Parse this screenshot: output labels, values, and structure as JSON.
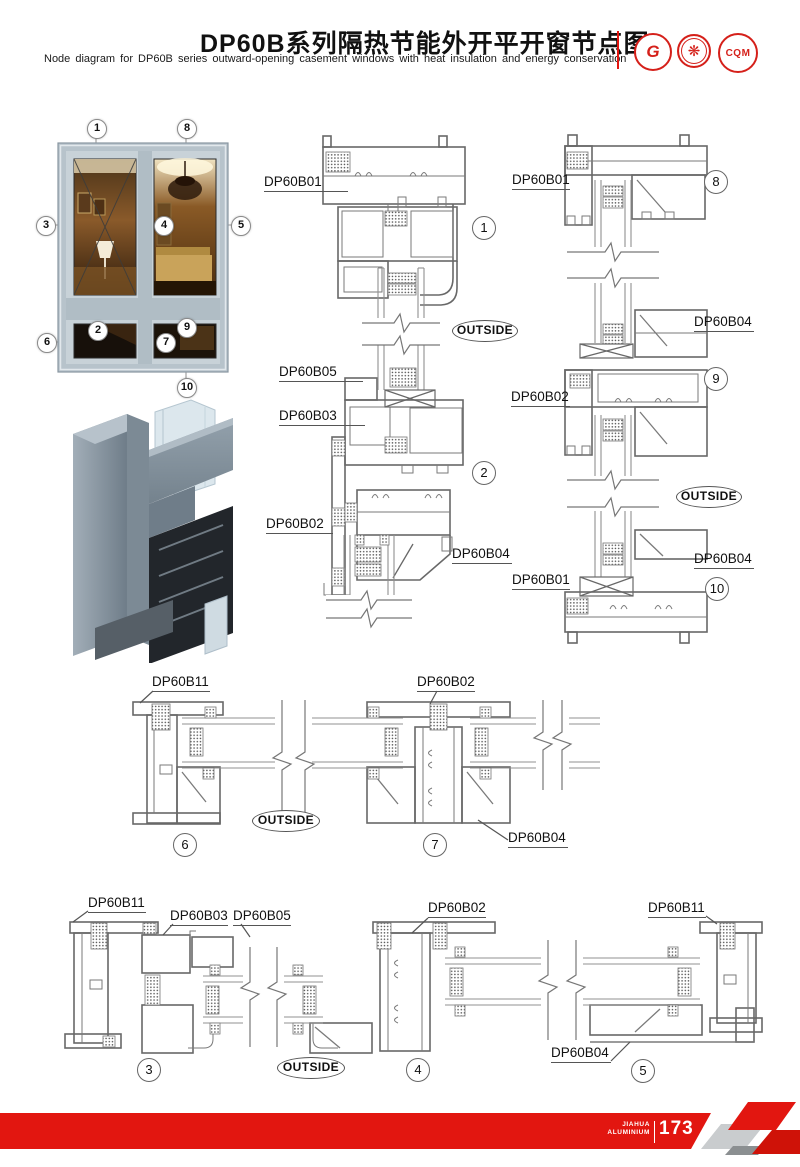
{
  "header": {
    "title": "DP60B系列隔热节能外开平开窗节点图",
    "subtitle": "Node diagram for DP60B series outward-opening casement windows with heat insulation and energy conservation",
    "logos": {
      "gb": "G",
      "seal": "❋",
      "cqm": "CQM"
    }
  },
  "photo": {
    "callouts": [
      "1",
      "8",
      "3",
      "4",
      "5",
      "2",
      "9",
      "6",
      "7",
      "10"
    ]
  },
  "drawings": {
    "outside": "OUTSIDE",
    "d12": {
      "labels": [
        "DP60B01",
        "DP60B05",
        "DP60B03",
        "DP60B02",
        "DP60B04"
      ],
      "details": [
        "1",
        "2"
      ]
    },
    "d8910": {
      "labels": [
        "DP60B01",
        "DP60B04",
        "DP60B02",
        "DP60B04",
        "DP60B01"
      ],
      "details": [
        "8",
        "9",
        "10"
      ]
    },
    "d67": {
      "labels": [
        "DP60B11",
        "DP60B02",
        "DP60B04"
      ],
      "details": [
        "6",
        "7"
      ]
    },
    "d345": {
      "labels": [
        "DP60B11",
        "DP60B03",
        "DP60B05",
        "DP60B02",
        "DP60B11",
        "DP60B04"
      ],
      "details": [
        "3",
        "4",
        "5"
      ]
    }
  },
  "footer": {
    "brand_top": "JIAHUA",
    "brand_bottom": "ALUMINIUM",
    "page": "173"
  },
  "colors": {
    "accent_red": "#e21610",
    "line_gray": "#6b6b6b",
    "frame_blue": "#b6c3cb"
  }
}
